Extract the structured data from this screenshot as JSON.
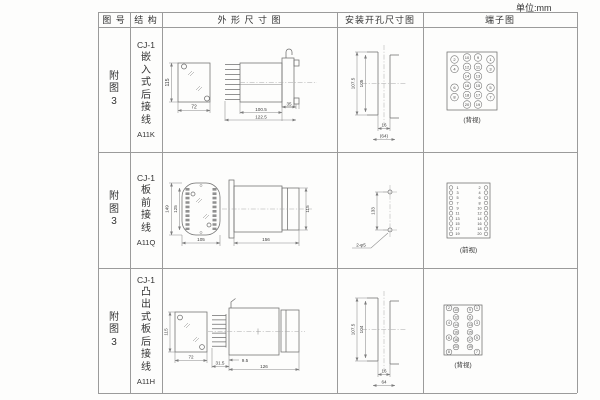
{
  "unit_label": "单位:mm",
  "table": {
    "headers": [
      "图 号",
      "结 构",
      "外 形 尺 寸 图",
      "安装开孔尺寸图",
      "端子图"
    ],
    "rows": [
      {
        "fig_label": "附图3",
        "series": "CJ-1",
        "structure": "嵌入式后接线",
        "code": "A11K",
        "outline": {
          "height": "115",
          "width": "72",
          "flange": "35",
          "body": "100.5",
          "total": "122.5"
        },
        "mounting": {
          "outer": "107.5",
          "inner": "105",
          "slot": "16",
          "spacing": "(64)"
        },
        "terminal": {
          "layout": "grid4",
          "view_label": "(背视)",
          "inner_rows": [
            [
              10,
              9
            ],
            [
              12,
              11
            ],
            [
              14,
              13
            ],
            [
              16,
              15
            ],
            [
              18,
              17
            ],
            [
              20,
              19
            ]
          ],
          "outer_left": [
            2,
            4,
            6,
            8
          ],
          "outer_right": [
            1,
            3,
            5,
            7
          ]
        }
      },
      {
        "fig_label": "附图3",
        "series": "CJ-1",
        "structure": "板前接线",
        "code": "A11Q",
        "outline": {
          "outer_height": "149",
          "inner_height": "125",
          "width": "105",
          "depth": "156",
          "height": "115"
        },
        "mounting": {
          "pitch": "133",
          "holes": "2-φ5"
        },
        "terminal": {
          "layout": "twocol",
          "view_label": "(前视)",
          "left": [
            1,
            3,
            5,
            7,
            9,
            11,
            13,
            15,
            17,
            19
          ],
          "right": [
            2,
            4,
            6,
            8,
            10,
            12,
            14,
            16,
            18,
            20
          ]
        }
      },
      {
        "fig_label": "附图3",
        "series": "CJ-1",
        "structure": "凸出式板后接线",
        "code": "A11H",
        "outline": {
          "height": "115",
          "width": "72",
          "pin_len": "31.5",
          "offset": "9.5",
          "depth": "126"
        },
        "mounting": {
          "outer": "107.5",
          "inner": "104",
          "slot": "16",
          "spacing": "64"
        },
        "terminal": {
          "layout": "staggered",
          "view_label": "(背视)",
          "outer_left": [
            2,
            4,
            6,
            8
          ],
          "inner_left": [
            10,
            12,
            14,
            16,
            18,
            20
          ],
          "inner_right": [
            9,
            11,
            13,
            15,
            17,
            19
          ],
          "outer_right": [
            1,
            3,
            5,
            7
          ]
        }
      }
    ]
  }
}
